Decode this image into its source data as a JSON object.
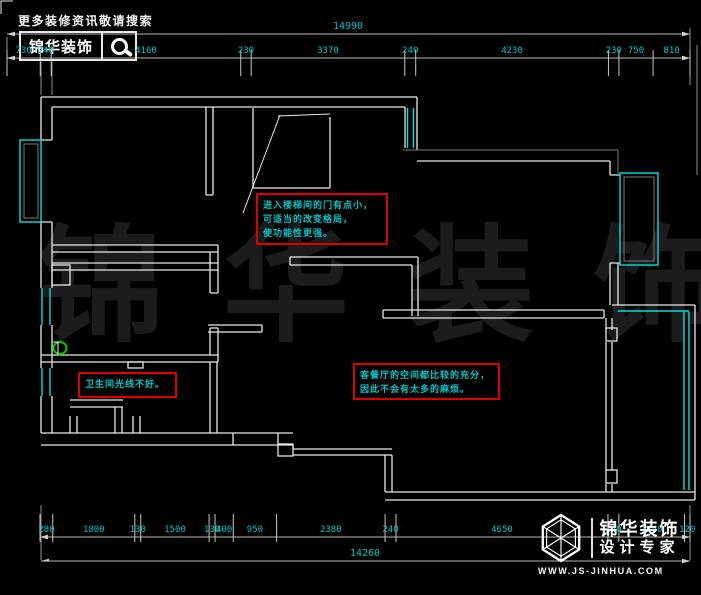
{
  "banner": {
    "slogan": "更多装修资讯敬请搜索",
    "brand": "锦华装饰"
  },
  "dims_top": {
    "total_label": "14990",
    "segments": [
      730,
      240,
      4160,
      230,
      3370,
      240,
      4230,
      230,
      750,
      810
    ]
  },
  "dims_bottom": {
    "total_label": "14260",
    "segments": [
      280,
      1800,
      130,
      1500,
      130,
      400,
      950,
      2380,
      240,
      4650,
      240,
      1440,
      120
    ]
  },
  "annotations": {
    "stairs": {
      "lines": [
        "进入楼梯间的门有点小，",
        "可适当的改变格局，",
        "使功能性更强。"
      ]
    },
    "living": {
      "lines": [
        "客餐厅的空间都比较的充分，",
        "因此不会有太多的麻烦。"
      ]
    },
    "bath": {
      "lines": [
        "卫生间光线不好。"
      ]
    }
  },
  "watermark": {
    "text": "锦 华 装 饰"
  },
  "footer": {
    "brand": "锦华装饰",
    "tagline": "设计专家",
    "url": "WWW.JS-JINHUA.COM"
  },
  "colors": {
    "background": "#000000",
    "wall": "#e8e8e8",
    "window": "#00e0e0",
    "dimension_text": "#00c8c8",
    "annotation_border": "#e00000",
    "annotation_text": "#00c8c8",
    "highlight_green": "#00cc00",
    "watermark": "#1c1c1e"
  }
}
